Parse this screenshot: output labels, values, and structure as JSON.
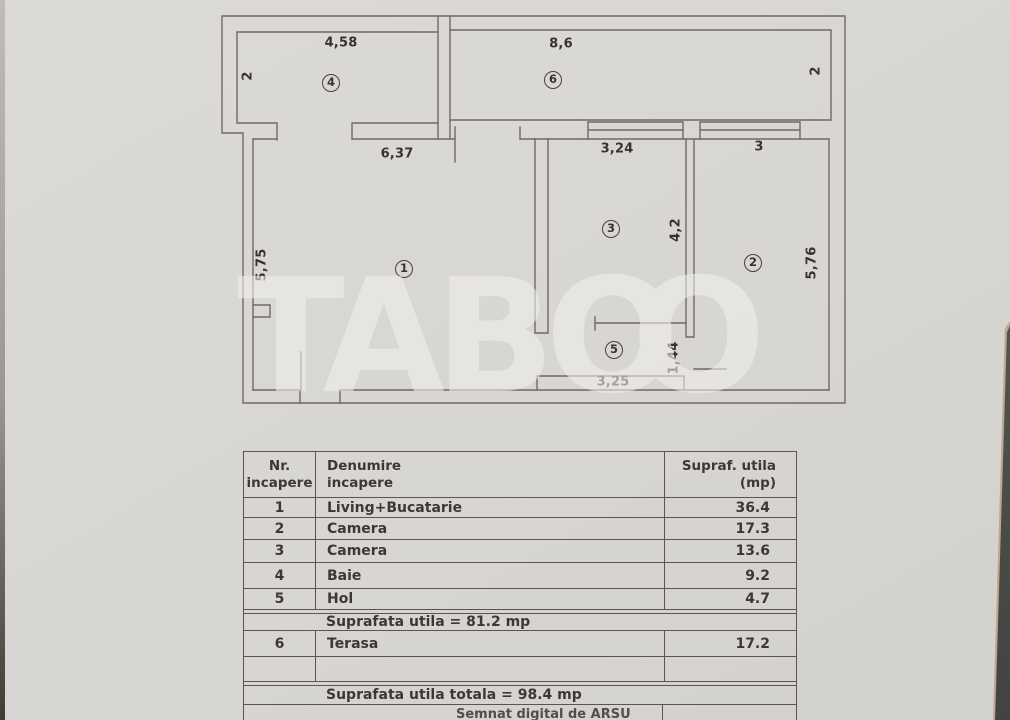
{
  "watermark": {
    "part1": "TAB",
    "part2": "O",
    "part3": "O"
  },
  "plan": {
    "rooms": [
      {
        "num": "1"
      },
      {
        "num": "2"
      },
      {
        "num": "3"
      },
      {
        "num": "4"
      },
      {
        "num": "5"
      },
      {
        "num": "6"
      }
    ],
    "dims": {
      "room4_width": "4,58",
      "room4_height": "2",
      "room6_width": "8,6",
      "room6_height": "2",
      "room1_width": "6,37",
      "room1_height": "5,75",
      "room3_width": "3,24",
      "room3_height": "4,2",
      "room2_width": "3",
      "room2_height": "5,76",
      "hall_width": "3,25",
      "hall_height": "1,44"
    }
  },
  "table": {
    "header": {
      "col1_line1": "Nr.",
      "col1_line2": "incapere",
      "col2_line1": "Denumire",
      "col2_line2": "incapere",
      "col3_line1": "Supraf. utila",
      "col3_line2": "(mp)"
    },
    "rows": [
      {
        "nr": "1",
        "name": "Living+Bucatarie",
        "area": "36.4"
      },
      {
        "nr": "2",
        "name": "Camera",
        "area": "17.3"
      },
      {
        "nr": "3",
        "name": "Camera",
        "area": "13.6"
      },
      {
        "nr": "4",
        "name": "Baie",
        "area": "9.2"
      },
      {
        "nr": "5",
        "name": "Hol",
        "area": "4.7"
      }
    ],
    "subtotal": "Suprafata utila = 81.2 mp",
    "terrace_row": {
      "nr": "6",
      "name": "Terasa",
      "area": "17.2"
    },
    "empty_row": {
      "nr": "",
      "name": "",
      "area": ""
    },
    "total": "Suprafata utila totala = 98.4 mp",
    "signature": "Semnat digital de ARSU"
  }
}
